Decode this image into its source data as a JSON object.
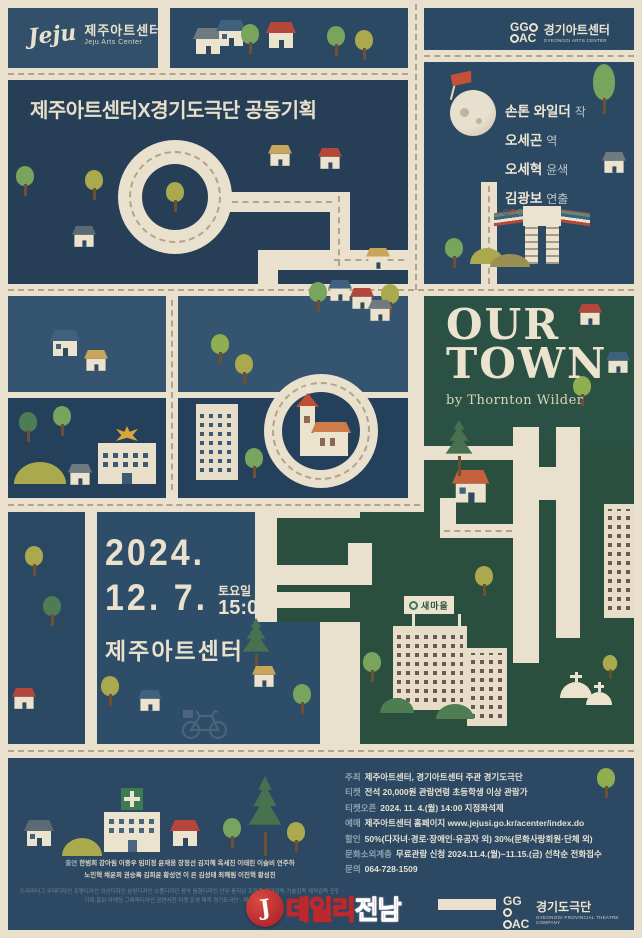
{
  "jeju_logo": {
    "script": "Jeju",
    "name_kr": "제주아트센터",
    "name_en": "Jeju Arts Center"
  },
  "ggac_logo": {
    "line1": "GG",
    "line2": "AC",
    "name_kr": "경기아트센터",
    "name_en": "GYEONGGI ARTS CENTER"
  },
  "co_plan": "제주아트센터X경기도극단 공동기획",
  "credits": [
    {
      "name": "손톤 와일더",
      "role": "작"
    },
    {
      "name": "오세곤",
      "role": "역"
    },
    {
      "name": "오세혁",
      "role": "윤색"
    },
    {
      "name": "김광보",
      "role": "연출"
    }
  ],
  "title": {
    "line1": "OUR",
    "line2": "TOWN",
    "byline": "by Thornton Wilder"
  },
  "schedule": {
    "year": "2024.",
    "date": "12. 7.",
    "day": "토요일",
    "time": "15:00",
    "venue": "제주아트센터"
  },
  "saemaul_sign": "새마을",
  "info": [
    {
      "label": "주최",
      "value": "제주아트센터, 경기아트센터  주관 경기도극단"
    },
    {
      "label": "티켓",
      "value": "전석 20,000원  관람연령 초등학생 이상 관람가"
    },
    {
      "label": "티켓오픈",
      "value": "2024. 11. 4.(월) 14:00 지정좌석제"
    },
    {
      "label": "예매",
      "value": "제주아트센터 홈페이지 www.jejusi.go.kr/acenter/index.do"
    },
    {
      "label": "할인",
      "value": "50%(다자녀·경로·장애인·유공자 외) 30%(문화사랑회원·단체 외)"
    },
    {
      "label": "문화소외계층",
      "value": "무료관람 신청 2024.11.4.(월)~11.15.(금) 선착순 전화접수"
    },
    {
      "label": "문의",
      "value": "064-728-1509"
    }
  ],
  "cast": {
    "label": "출연",
    "line1": "한범희 강아림 이중우 임미정 윤재웅 장정선 김지혜 옥세진 이태린 이슬비 연주하",
    "line2": "노민혁 채윤희 권승록 김희윤 황성연 이 은 김성태 최혜림 이진혁 황성진"
  },
  "staff_fine_print": {
    "line1": "드라마터그 무대디자인 조명디자인 의상디자인 분장디자인 소품디자인 음악 음향디자인 안무 움직임 조연출 무대감독 기술감독 제작감독 진행 하우스매니저",
    "line2": "기획·홍보 마케팅 그래픽디자인 공연사진 티켓 운영 제작 경기도극단 · 제주아트센터"
  },
  "ggtc_logo": {
    "line1": "GG",
    "line2": "AC",
    "name_kr": "경기도극단",
    "name_en": "GYEONGGI PROVINCIAL THEATRE COMPANY"
  },
  "watermark": {
    "initial": "J",
    "text1": "데일리",
    "text2": "전남"
  }
}
